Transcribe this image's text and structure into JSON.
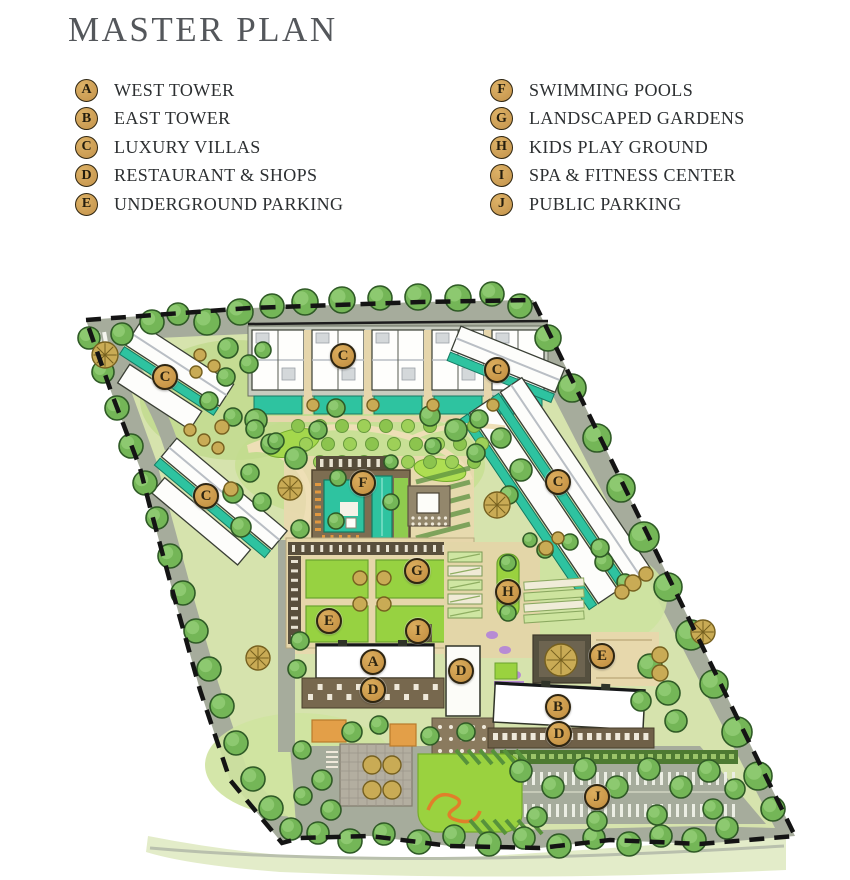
{
  "title": "MASTER PLAN",
  "legend": {
    "items": [
      {
        "letter": "A",
        "label": "WEST TOWER"
      },
      {
        "letter": "B",
        "label": "EAST TOWER"
      },
      {
        "letter": "C",
        "label": "LUXURY VILLAS"
      },
      {
        "letter": "D",
        "label": "RESTAURANT & SHOPS"
      },
      {
        "letter": "E",
        "label": "UNDERGROUND PARKING"
      },
      {
        "letter": "F",
        "label": "SWIMMING POOLS"
      },
      {
        "letter": "G",
        "label": "LANDSCAPED GARDENS"
      },
      {
        "letter": "H",
        "label": "KIDS PLAY GROUND"
      },
      {
        "letter": "I",
        "label": "SPA & FITNESS CENTER"
      },
      {
        "letter": "J",
        "label": "PUBLIC PARKING"
      }
    ]
  },
  "map": {
    "markers": [
      {
        "letter": "C",
        "area": "luxury-villas-northwest",
        "x": 165,
        "y": 97
      },
      {
        "letter": "C",
        "area": "luxury-villas-north-row",
        "x": 343,
        "y": 76
      },
      {
        "letter": "C",
        "area": "luxury-villas-northeast",
        "x": 497,
        "y": 90
      },
      {
        "letter": "C",
        "area": "luxury-villas-west",
        "x": 206,
        "y": 216
      },
      {
        "letter": "C",
        "area": "luxury-villas-east",
        "x": 558,
        "y": 202
      },
      {
        "letter": "F",
        "area": "swimming-pools",
        "x": 363,
        "y": 203
      },
      {
        "letter": "G",
        "area": "landscaped-gardens",
        "x": 417,
        "y": 291
      },
      {
        "letter": "H",
        "area": "kids-play-ground",
        "x": 508,
        "y": 312
      },
      {
        "letter": "E",
        "area": "underground-parking-west",
        "x": 329,
        "y": 341
      },
      {
        "letter": "I",
        "area": "spa-fitness-center",
        "x": 418,
        "y": 351
      },
      {
        "letter": "A",
        "area": "west-tower",
        "x": 373,
        "y": 382
      },
      {
        "letter": "D",
        "area": "restaurant-shops-center",
        "x": 461,
        "y": 391
      },
      {
        "letter": "E",
        "area": "underground-parking-east",
        "x": 602,
        "y": 376
      },
      {
        "letter": "D",
        "area": "restaurant-shops-west",
        "x": 373,
        "y": 410
      },
      {
        "letter": "B",
        "area": "east-tower",
        "x": 558,
        "y": 427
      },
      {
        "letter": "D",
        "area": "restaurant-shops-east",
        "x": 559,
        "y": 454
      },
      {
        "letter": "J",
        "area": "public-parking",
        "x": 597,
        "y": 517
      }
    ]
  },
  "colors": {
    "marker_gold": "#cf9f50",
    "marker_ring": "#2e2511",
    "title_gray": "#54575b",
    "text_dark": "#2c2f31",
    "road_gray": "#a6ac9c",
    "pool_teal": "#2ec3a0",
    "lawn_green": "#9ad23f"
  }
}
